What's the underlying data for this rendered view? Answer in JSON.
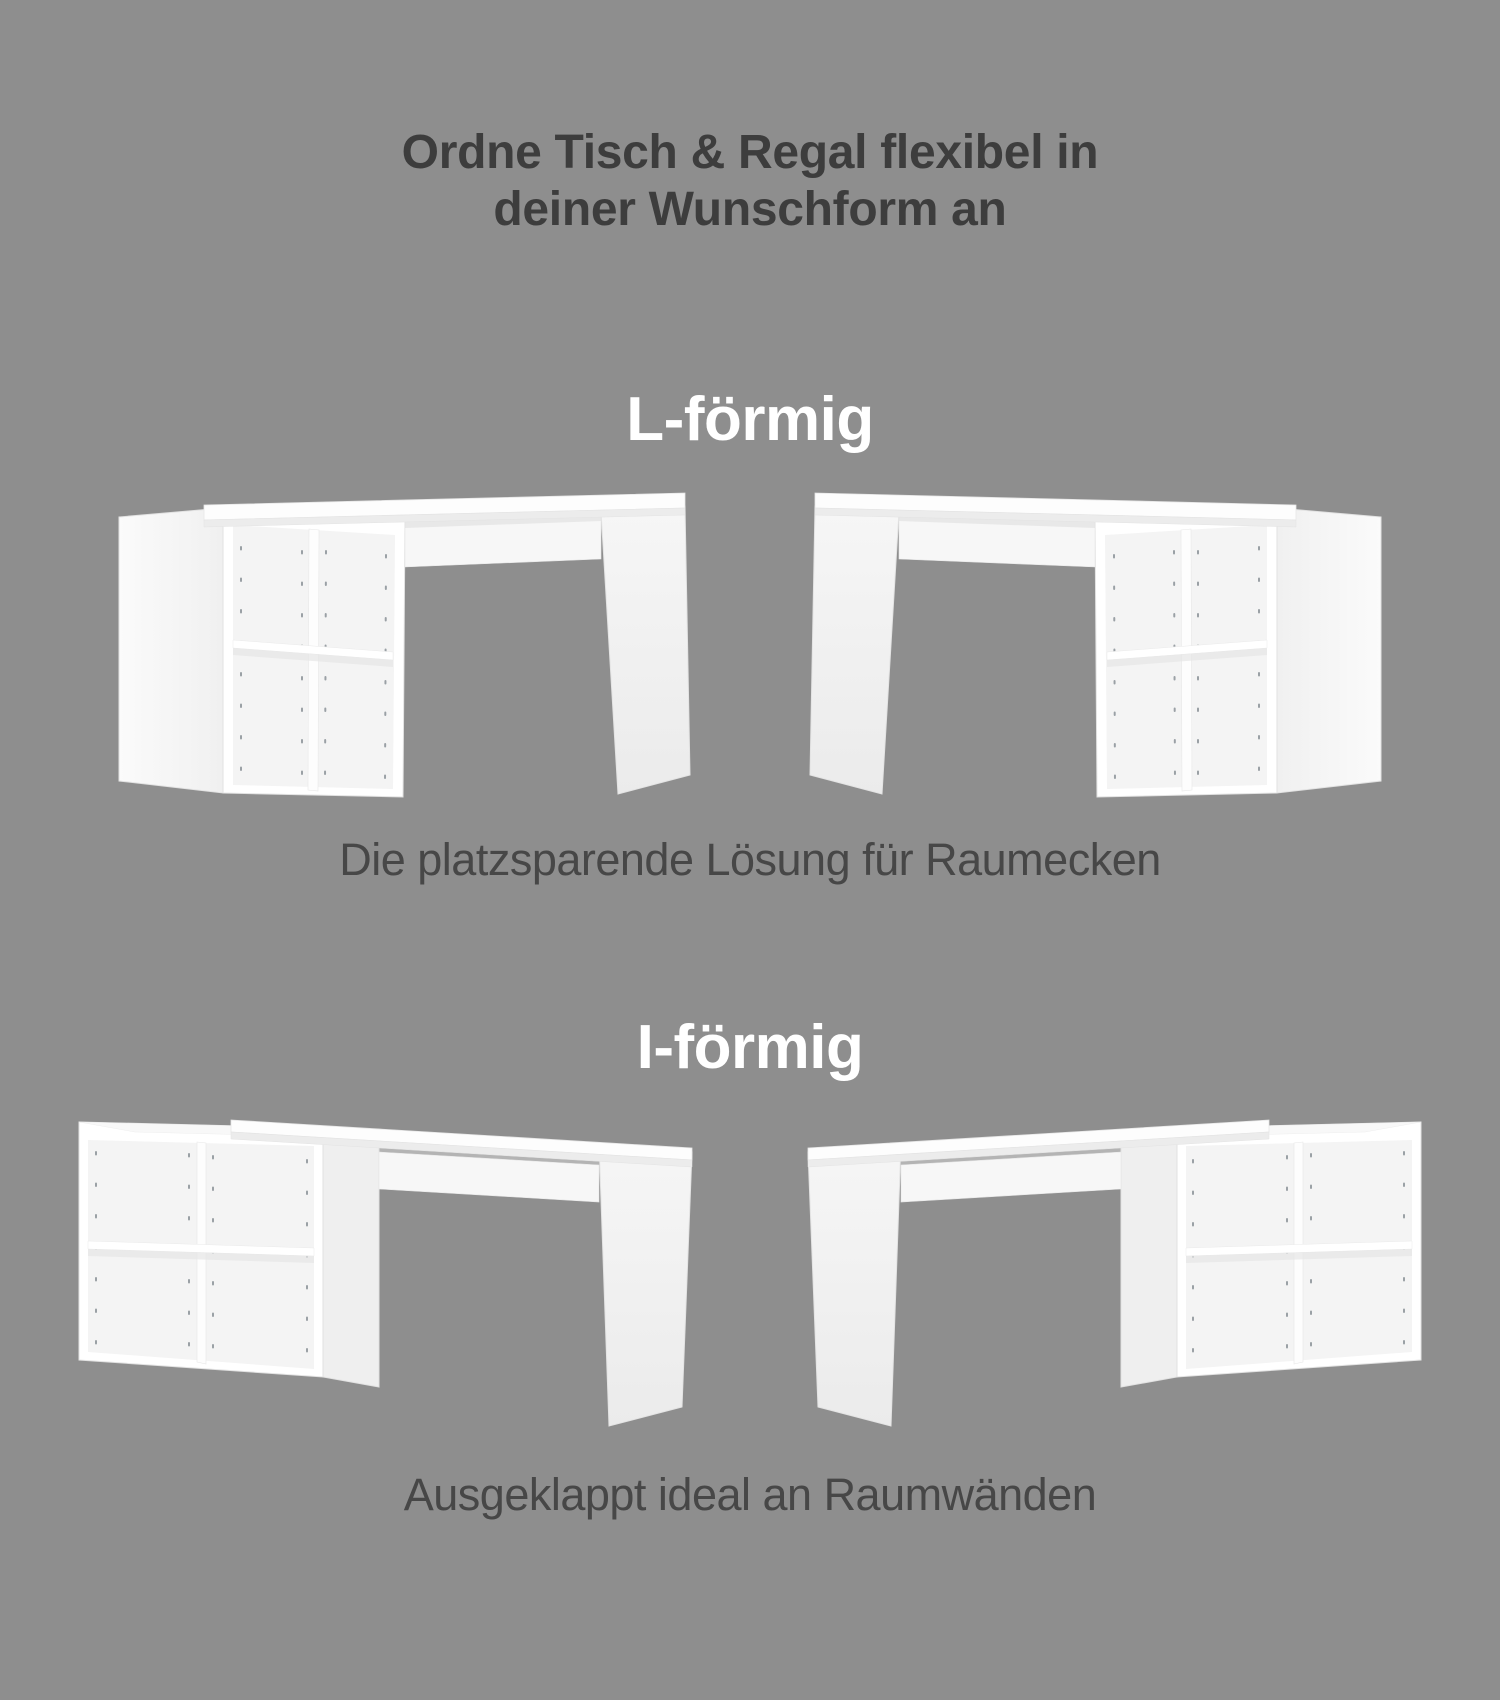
{
  "canvas": {
    "width": 1500,
    "height": 1700,
    "background_color": "#8e8e8e"
  },
  "title": {
    "line1": "Ordne Tisch & Regal flexibel in",
    "line2": "deiner Wunschform an",
    "color": "#3d3d3d"
  },
  "sections": [
    {
      "id": "l-foermig",
      "heading": "L-förmig",
      "heading_color": "#ffffff",
      "caption": "Die platzsparende Lösung für Raumecken",
      "caption_color": "#474747",
      "illustrations": [
        {
          "name": "l-shaped-desk-with-shelf-left"
        },
        {
          "name": "l-shaped-desk-with-shelf-right-mirrored"
        }
      ]
    },
    {
      "id": "i-foermig",
      "heading": "I-förmig",
      "heading_color": "#ffffff",
      "caption": "Ausgeklappt ideal an Raumwänden",
      "caption_color": "#474747",
      "illustrations": [
        {
          "name": "i-shaped-desk-with-shelf-left"
        },
        {
          "name": "i-shaped-desk-with-shelf-right-mirrored"
        }
      ]
    }
  ],
  "furniture_colors": {
    "surface_white": "#fdfdfd",
    "side_panel": "#f1f1f1",
    "interior": "#f4f4f4",
    "edge": "#e3e3e3",
    "under_shelf_shadow": "#e6e6e6",
    "pin_holes": "#8b9298"
  }
}
